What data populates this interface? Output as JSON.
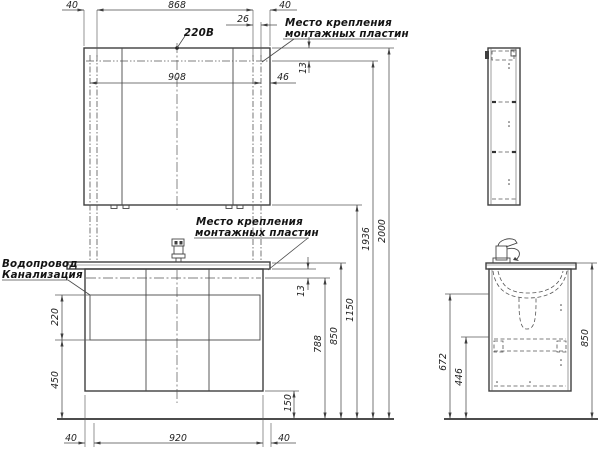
{
  "labels": {
    "power": "220В",
    "mount_top_1": "Место крепления",
    "mount_top_2": "монтажных пластин",
    "mount_mid_1": "Место крепления",
    "mount_mid_2": "монтажных пластин",
    "water": "Водопровод",
    "sewer": "Канализация"
  },
  "dims": {
    "top_left_40": "40",
    "top_868": "868",
    "top_26": "26",
    "top_right_40": "40",
    "mirror_908": "908",
    "mirror_46": "46",
    "mirror_13": "13",
    "counter_13": "13",
    "left_220": "220",
    "left_450": "450",
    "bottom_left_40": "40",
    "bottom_920": "920",
    "bottom_right_40": "40",
    "gap_150": "150",
    "h_788": "788",
    "h_850": "850",
    "h_1150": "1150",
    "h_1936": "1936",
    "h_2000": "2000",
    "side_672": "672",
    "side_446": "446",
    "side_850": "850"
  },
  "colors": {
    "line": "#3f3f3f",
    "text": "#1d1d1d",
    "background": "#ffffff"
  }
}
